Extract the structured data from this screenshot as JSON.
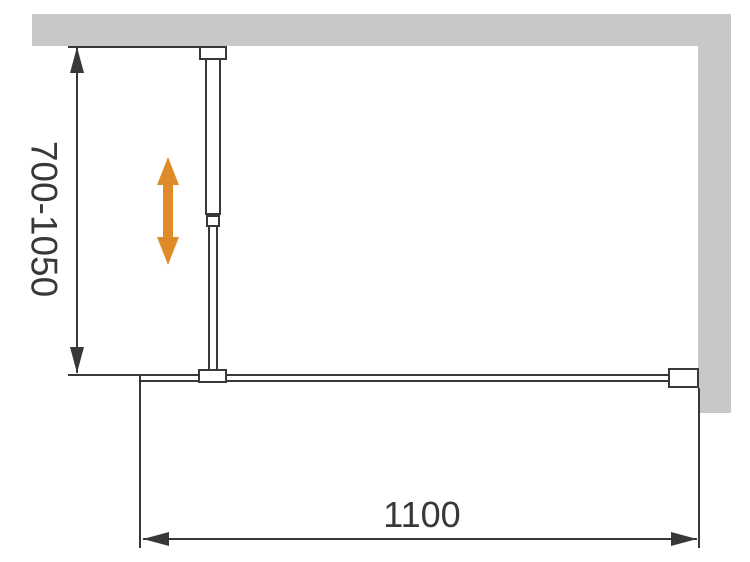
{
  "diagram": {
    "height_dimension": {
      "label": "700-1050"
    },
    "width_dimension": {
      "label": "1100"
    },
    "icons": {
      "adjustability": "double-headed-vertical-arrow"
    },
    "colors": {
      "wall": "#c8c8c8",
      "line": "#383838",
      "adjust_arrow": "#df8b2a",
      "background": "#ffffff"
    }
  }
}
